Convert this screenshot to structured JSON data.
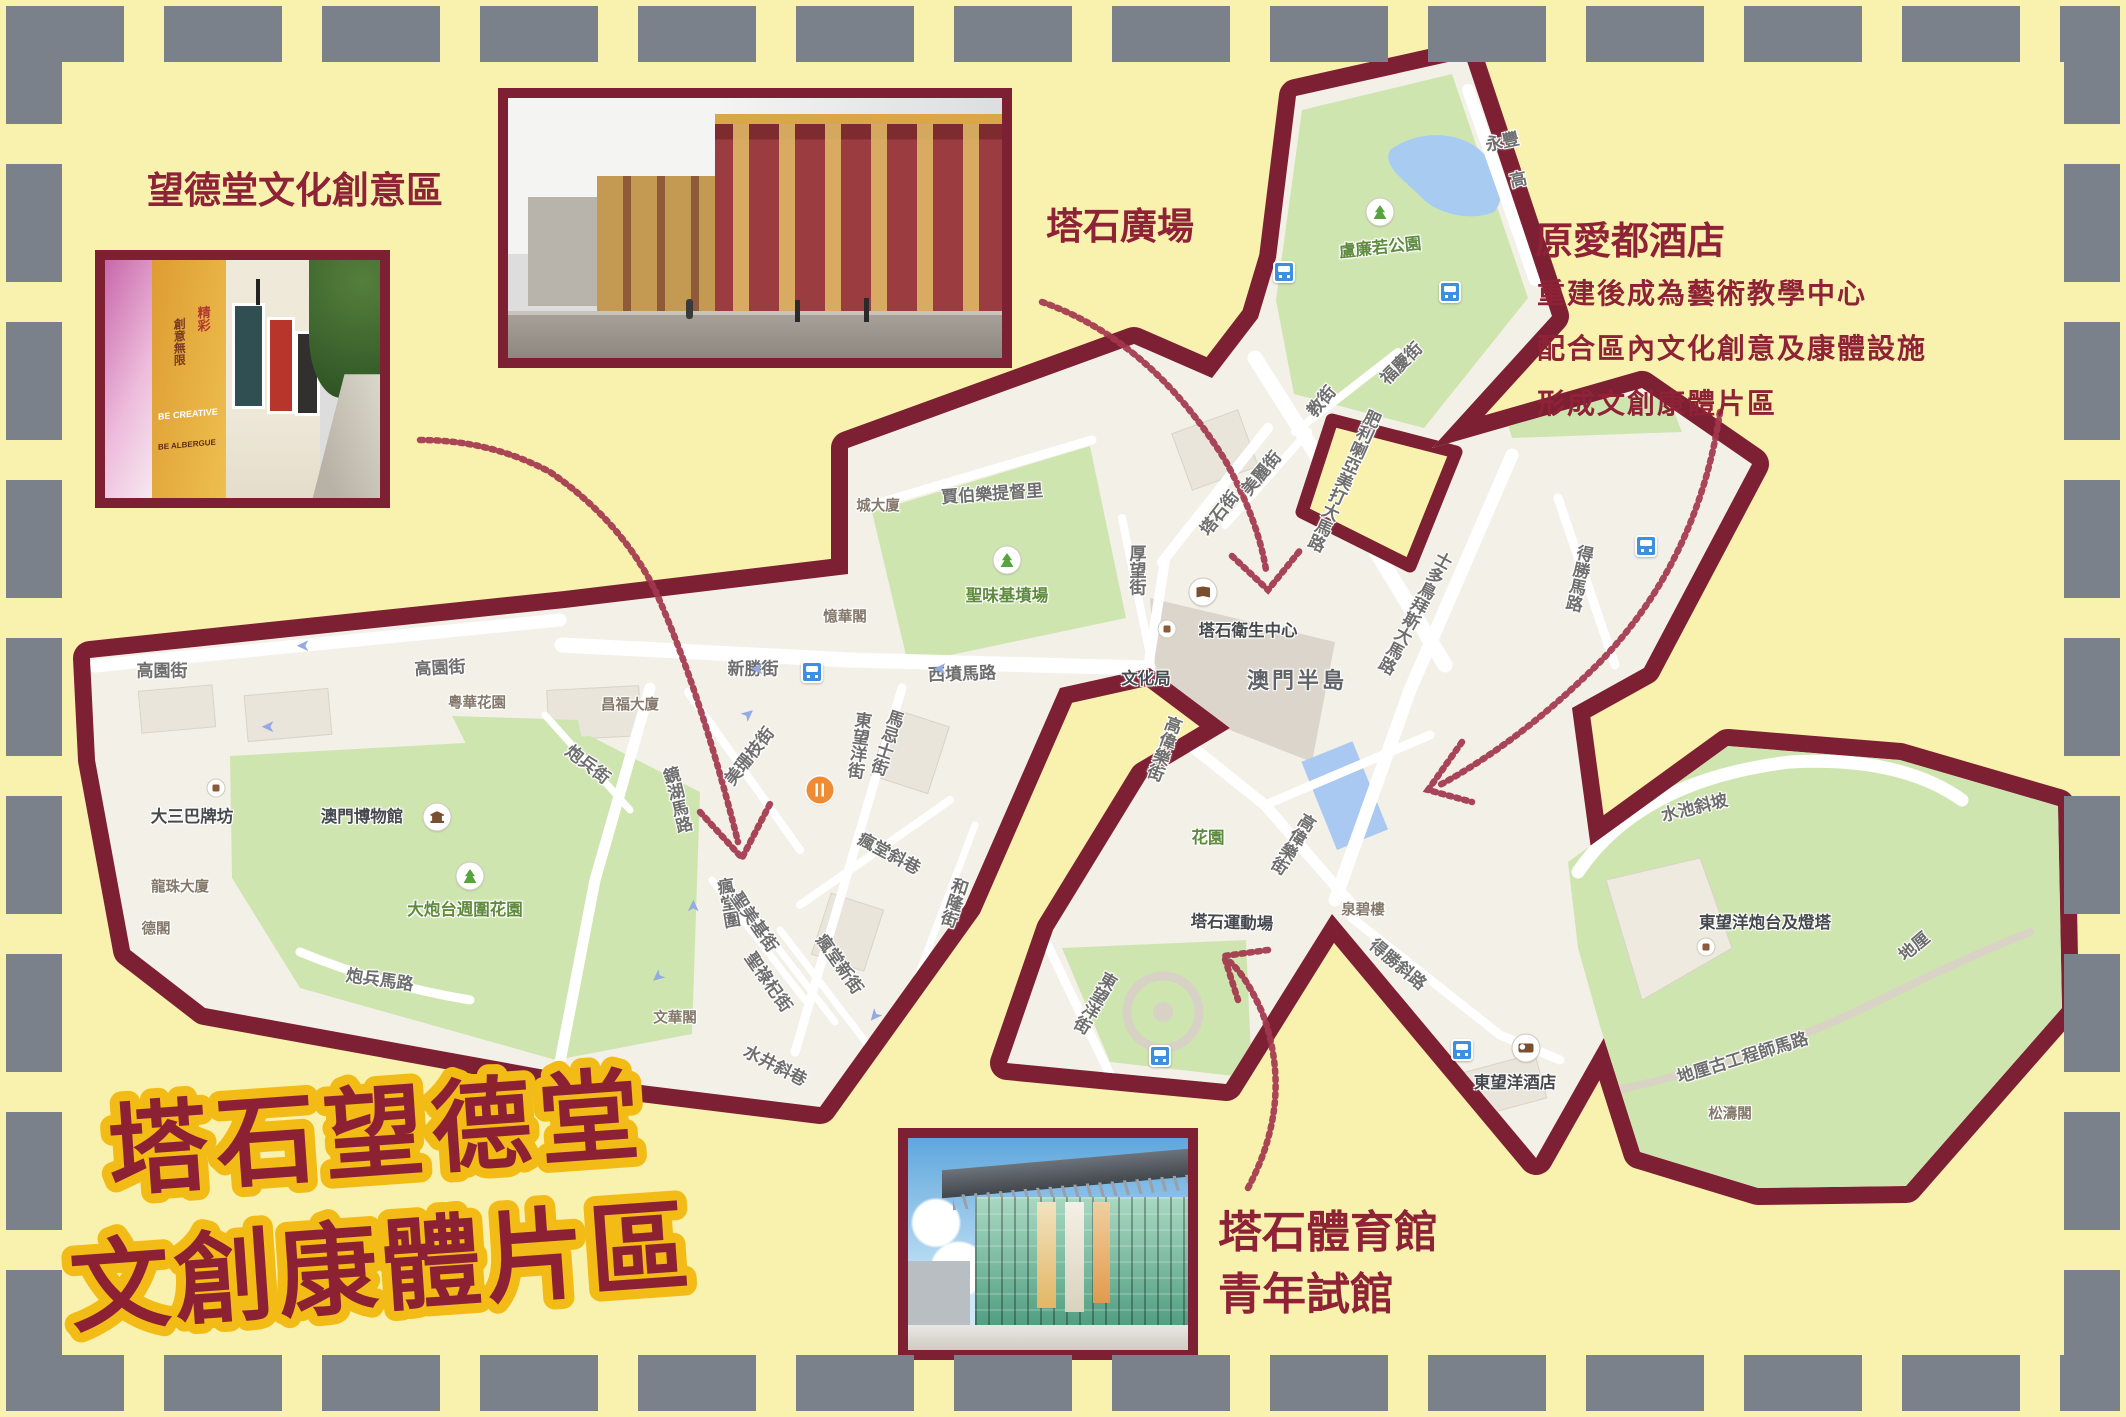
{
  "colors": {
    "page_bg": "#f9f1ae",
    "frame_gray": "#7b818b",
    "map_border": "#7d2033",
    "maroon_text": "#8e2236",
    "title_fill": "#8c2134",
    "title_gold": "#f3bb16",
    "crayon": "#a2364c",
    "park_green": "#cfe5b0",
    "water_blue": "#a8cbf2"
  },
  "title": {
    "line1": "塔石望德堂",
    "line2": "文創康體片區"
  },
  "callouts": {
    "creative": {
      "label": "望德堂文化創意區"
    },
    "square": {
      "label": "塔石廣場"
    },
    "estoril": {
      "title": "原愛都酒店",
      "line1": "重建後成為藝術教學中心",
      "line2": "配合區內文化創意及康體設施",
      "line3": "形成文創康體片區"
    },
    "pavilion": {
      "line1": "塔石體育館",
      "line2": "青年試館"
    }
  },
  "photo1": {
    "be_creative": "BE CREATIVE",
    "be_albergue": "BE ALBERGUE",
    "wonderful": "精彩",
    "creativity": "創意無限"
  },
  "map": {
    "icons": {
      "oneway": "➤"
    },
    "labels": {
      "gaoyuan1": "高園街",
      "gaoyuan2": "高園街",
      "yuehua": "粵華花園",
      "changfu": "昌福大廈",
      "paobing": "炮兵街",
      "jinghu": "鏡湖馬路",
      "meishanzhi": "美珊枝街",
      "xinsheng": "新勝街",
      "xifen": "西墳馬路",
      "majishi": "馬忌士街",
      "fengtangxiexiang": "瘋堂斜巷",
      "helong": "和隆街",
      "fengtangwei": "瘋堂圍",
      "shengmeiji": "聖美基街",
      "shengluqi": "聖祿杞街",
      "fengtangxin": "瘋堂新街",
      "shuijing": "水井斜巷",
      "wenhuage": "文華閣",
      "houwang": "厚望街",
      "tashijie": "塔石街",
      "meili": "美麗街",
      "jiaojie": "教街",
      "feilila": "肥利喇亞美打大馬路",
      "shiduoniao": "士多鳥拜斯大馬路",
      "fuqing": "福慶街",
      "yongfeng": "永豐",
      "gao": "高",
      "lulianruo": "盧廉若公園",
      "jiabole": "賈伯樂提督里",
      "chengdasha": "城大廈",
      "shengweiji": "聖味基墳場",
      "yihuage": "憶華閣",
      "weisheng": "塔石衛生中心",
      "wenhuaju": "文化局",
      "bandao": "澳門半島",
      "gaoweile1": "高偉樂街",
      "gaoweile2": "高偉樂街",
      "dongwangyang1": "東望洋街",
      "dongwangyang2": "東望洋街",
      "huayuan": "花園",
      "yundongchang": "塔石運動場",
      "quanbilou": "泉碧樓",
      "deshengma": "得勝馬路",
      "deshengxie": "得勝斜路",
      "hotel": "東望洋酒店",
      "songtaoge": "松濤閣",
      "dili": "地厘古工程師馬路",
      "shuichi": "水池斜坡",
      "paotai": "東望洋炮台及燈塔",
      "dilipartial": "地厘",
      "sanba": "大三巴牌坊",
      "bowuguan": "澳門博物館",
      "longzhu": "龍珠大廈",
      "dege": "德閣",
      "dapaotai": "大炮台週圍花園",
      "paobingmalu": "炮兵馬路"
    }
  }
}
